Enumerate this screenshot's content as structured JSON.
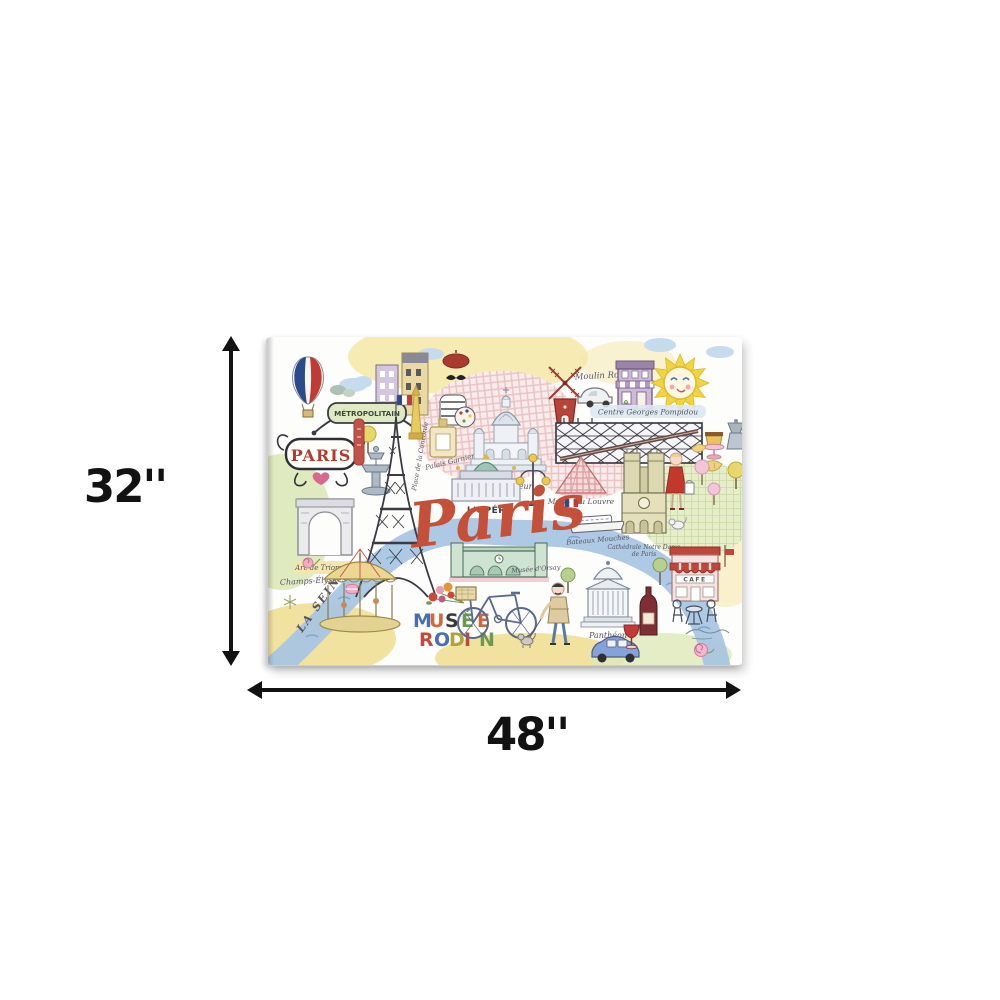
{
  "dimensions": {
    "height_label": "32''",
    "width_label": "48''"
  },
  "art": {
    "labels": {
      "paris_script": "Paris",
      "paris_sign": "PARIS",
      "metro": "MÉTROPOLITAIN",
      "arc": "Arc de Triomphe",
      "champs": "Champs-Élysées",
      "seine": "LA SEINE",
      "concorde": "Place de la Concorde",
      "garnier": "Palais Garnier",
      "sacre": "Sacré-Cœur",
      "moulin": "Moulin Rouge",
      "pompidou": "Centre Georges Pompidou",
      "opera": "L'OPÉRA",
      "louvre": "Musée du Louvre",
      "notre_dame_1": "Cathédrale Notre Dame",
      "notre_dame_2": "de Paris",
      "bateaux": "Bateaux Mouches",
      "orsay": "Musée d'Orsay",
      "pantheon": "Panthéon",
      "cafe": "CAFE"
    },
    "musee_rodin": {
      "word1": [
        "M",
        "U",
        "S",
        "É",
        "E"
      ],
      "word1_colors": [
        "#4a6fae",
        "#d2693a",
        "#3a3a3a",
        "#6a9a4f",
        "#c8693f"
      ],
      "word2": [
        "R",
        "O",
        "D",
        "I",
        "N"
      ],
      "word2_colors": [
        "#c34a3a",
        "#4a6fae",
        "#b5a13a",
        "#c34a3a",
        "#6a9a4f"
      ]
    },
    "colors": {
      "script_red": "#c4503a",
      "river_blue": "#a9c6e2",
      "wash_yellow": "#f3e39b",
      "wash_green": "#dde8b8",
      "wash_pink": "#fbecec",
      "ink": "#3b3b44",
      "sun_yellow": "#f2d440",
      "flag_blue": "#2b4a8b",
      "flag_red": "#bf3b33",
      "dimension_black": "#121212"
    }
  }
}
